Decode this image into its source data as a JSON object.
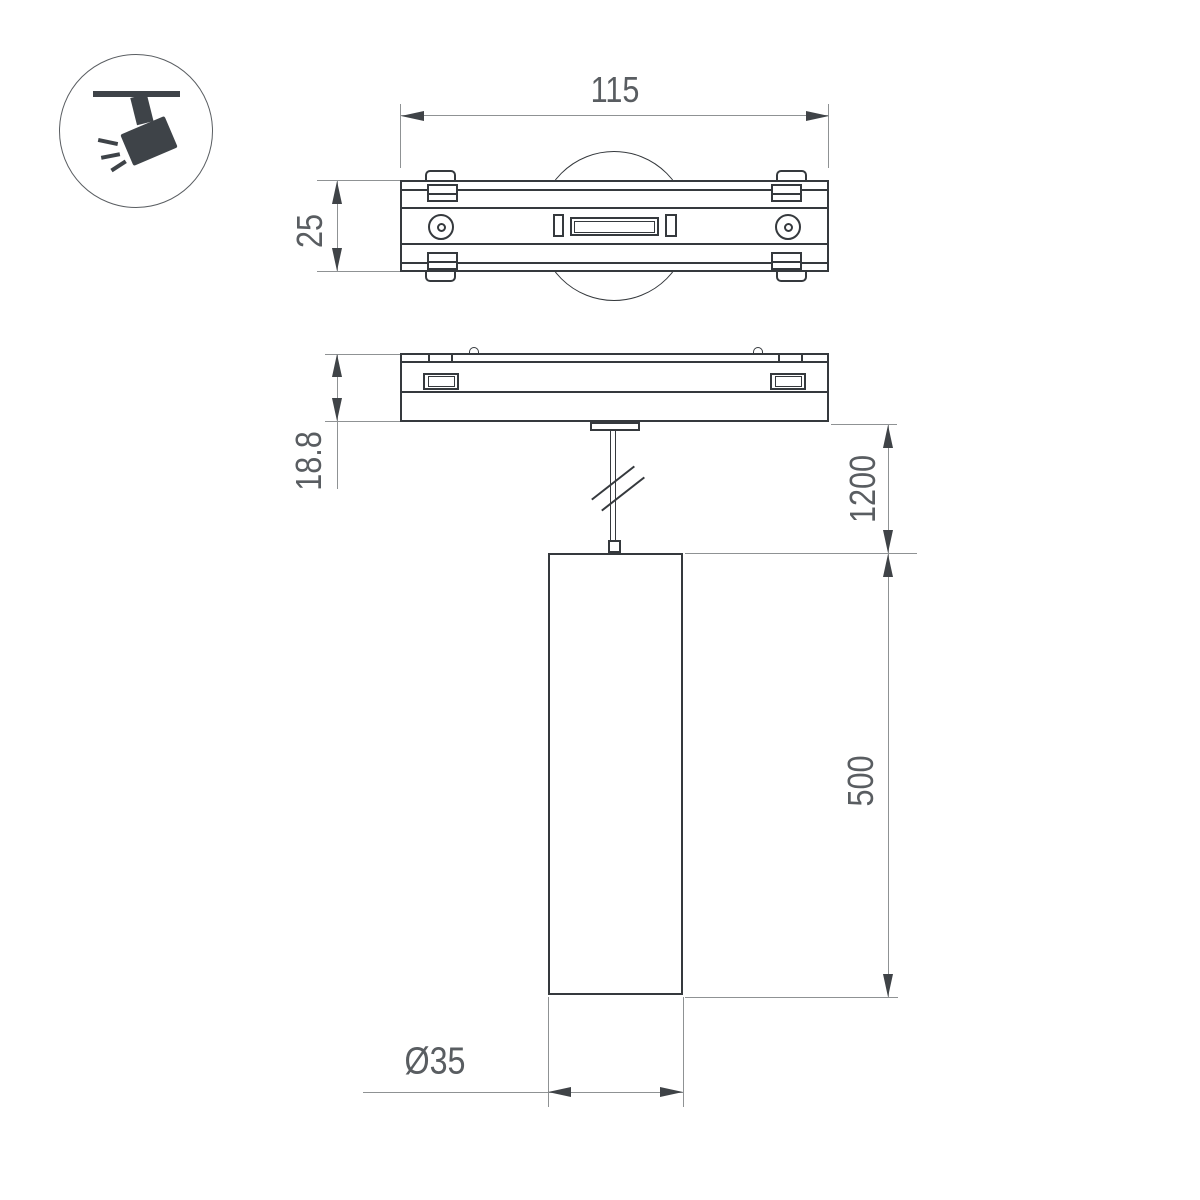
{
  "icon": {
    "name": "track-spotlight",
    "color": "#3e4348"
  },
  "labels": {
    "track_width": "115",
    "track_depth": "25",
    "adapter_thickness": "18.8",
    "suspension_length": "1200",
    "lamp_height": "500",
    "lamp_diameter": "Ø35"
  },
  "colors": {
    "background": "#ffffff",
    "outline": "#35393d",
    "dim_line": "#8f9294",
    "arrow": "#3f4347",
    "text": "#595d61",
    "icon": "#3e4348"
  }
}
